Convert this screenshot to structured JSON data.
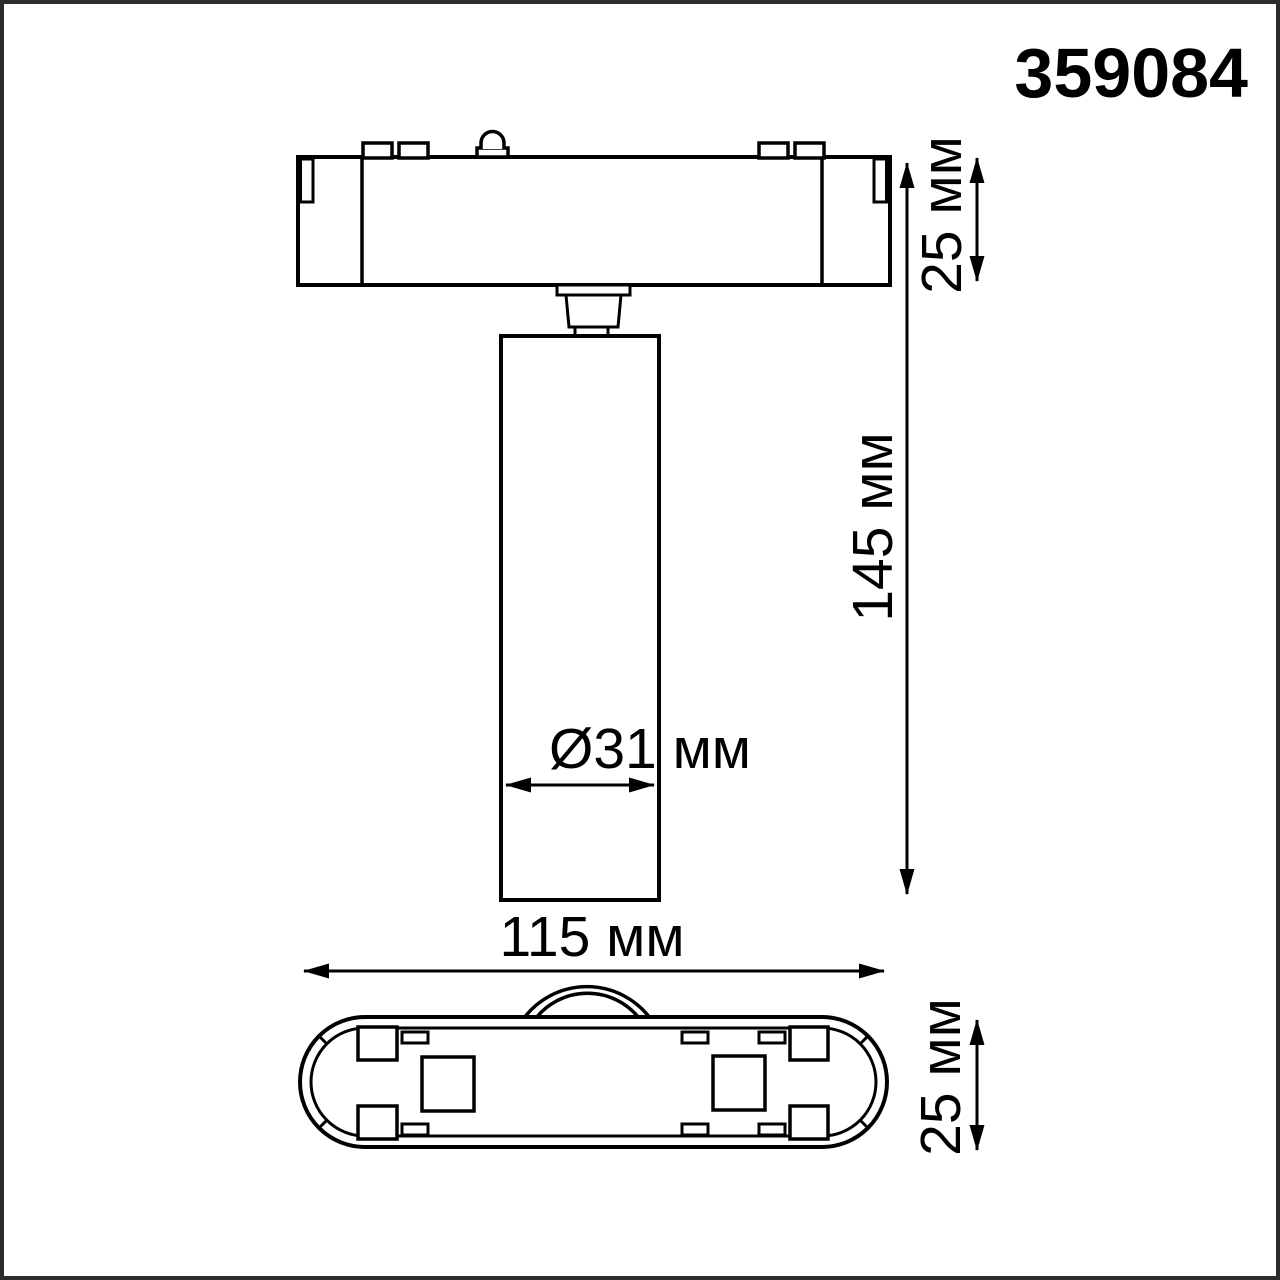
{
  "product_code": "359084",
  "dimensions": {
    "adapter_height": "25 мм",
    "total_height": "145 мм",
    "diameter": "Ø31 мм",
    "width": "115 мм",
    "base_height": "25 мм"
  },
  "colors": {
    "line": "#000000",
    "frame": "#2d2d2d",
    "background": "#ffffff"
  }
}
